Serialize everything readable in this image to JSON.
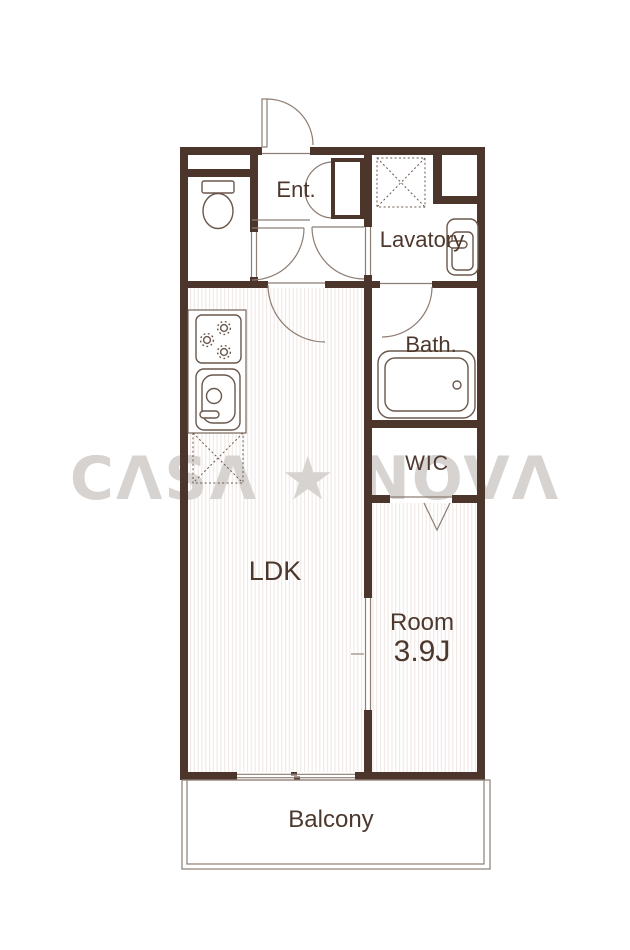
{
  "floorplan": {
    "watermark": "CΛSΛ ★ NOVΛ",
    "rooms": {
      "entrance": {
        "label": "Ent."
      },
      "lavatory": {
        "label": "Lavatory"
      },
      "bath": {
        "label": "Bath."
      },
      "wic": {
        "label": "WIC"
      },
      "ldk": {
        "label": "LDK"
      },
      "bedroom": {
        "label": "Room",
        "size": "3.9J"
      },
      "balcony": {
        "label": "Balcony"
      }
    },
    "colors": {
      "wall": "#4c362b",
      "label_text": "#4d382e",
      "fixture_stroke": "#6a574c",
      "door_line": "#8d7d73",
      "floor_stripe": "#f0e7e3",
      "watermark": "#d6d3d1",
      "background": "#ffffff"
    }
  }
}
